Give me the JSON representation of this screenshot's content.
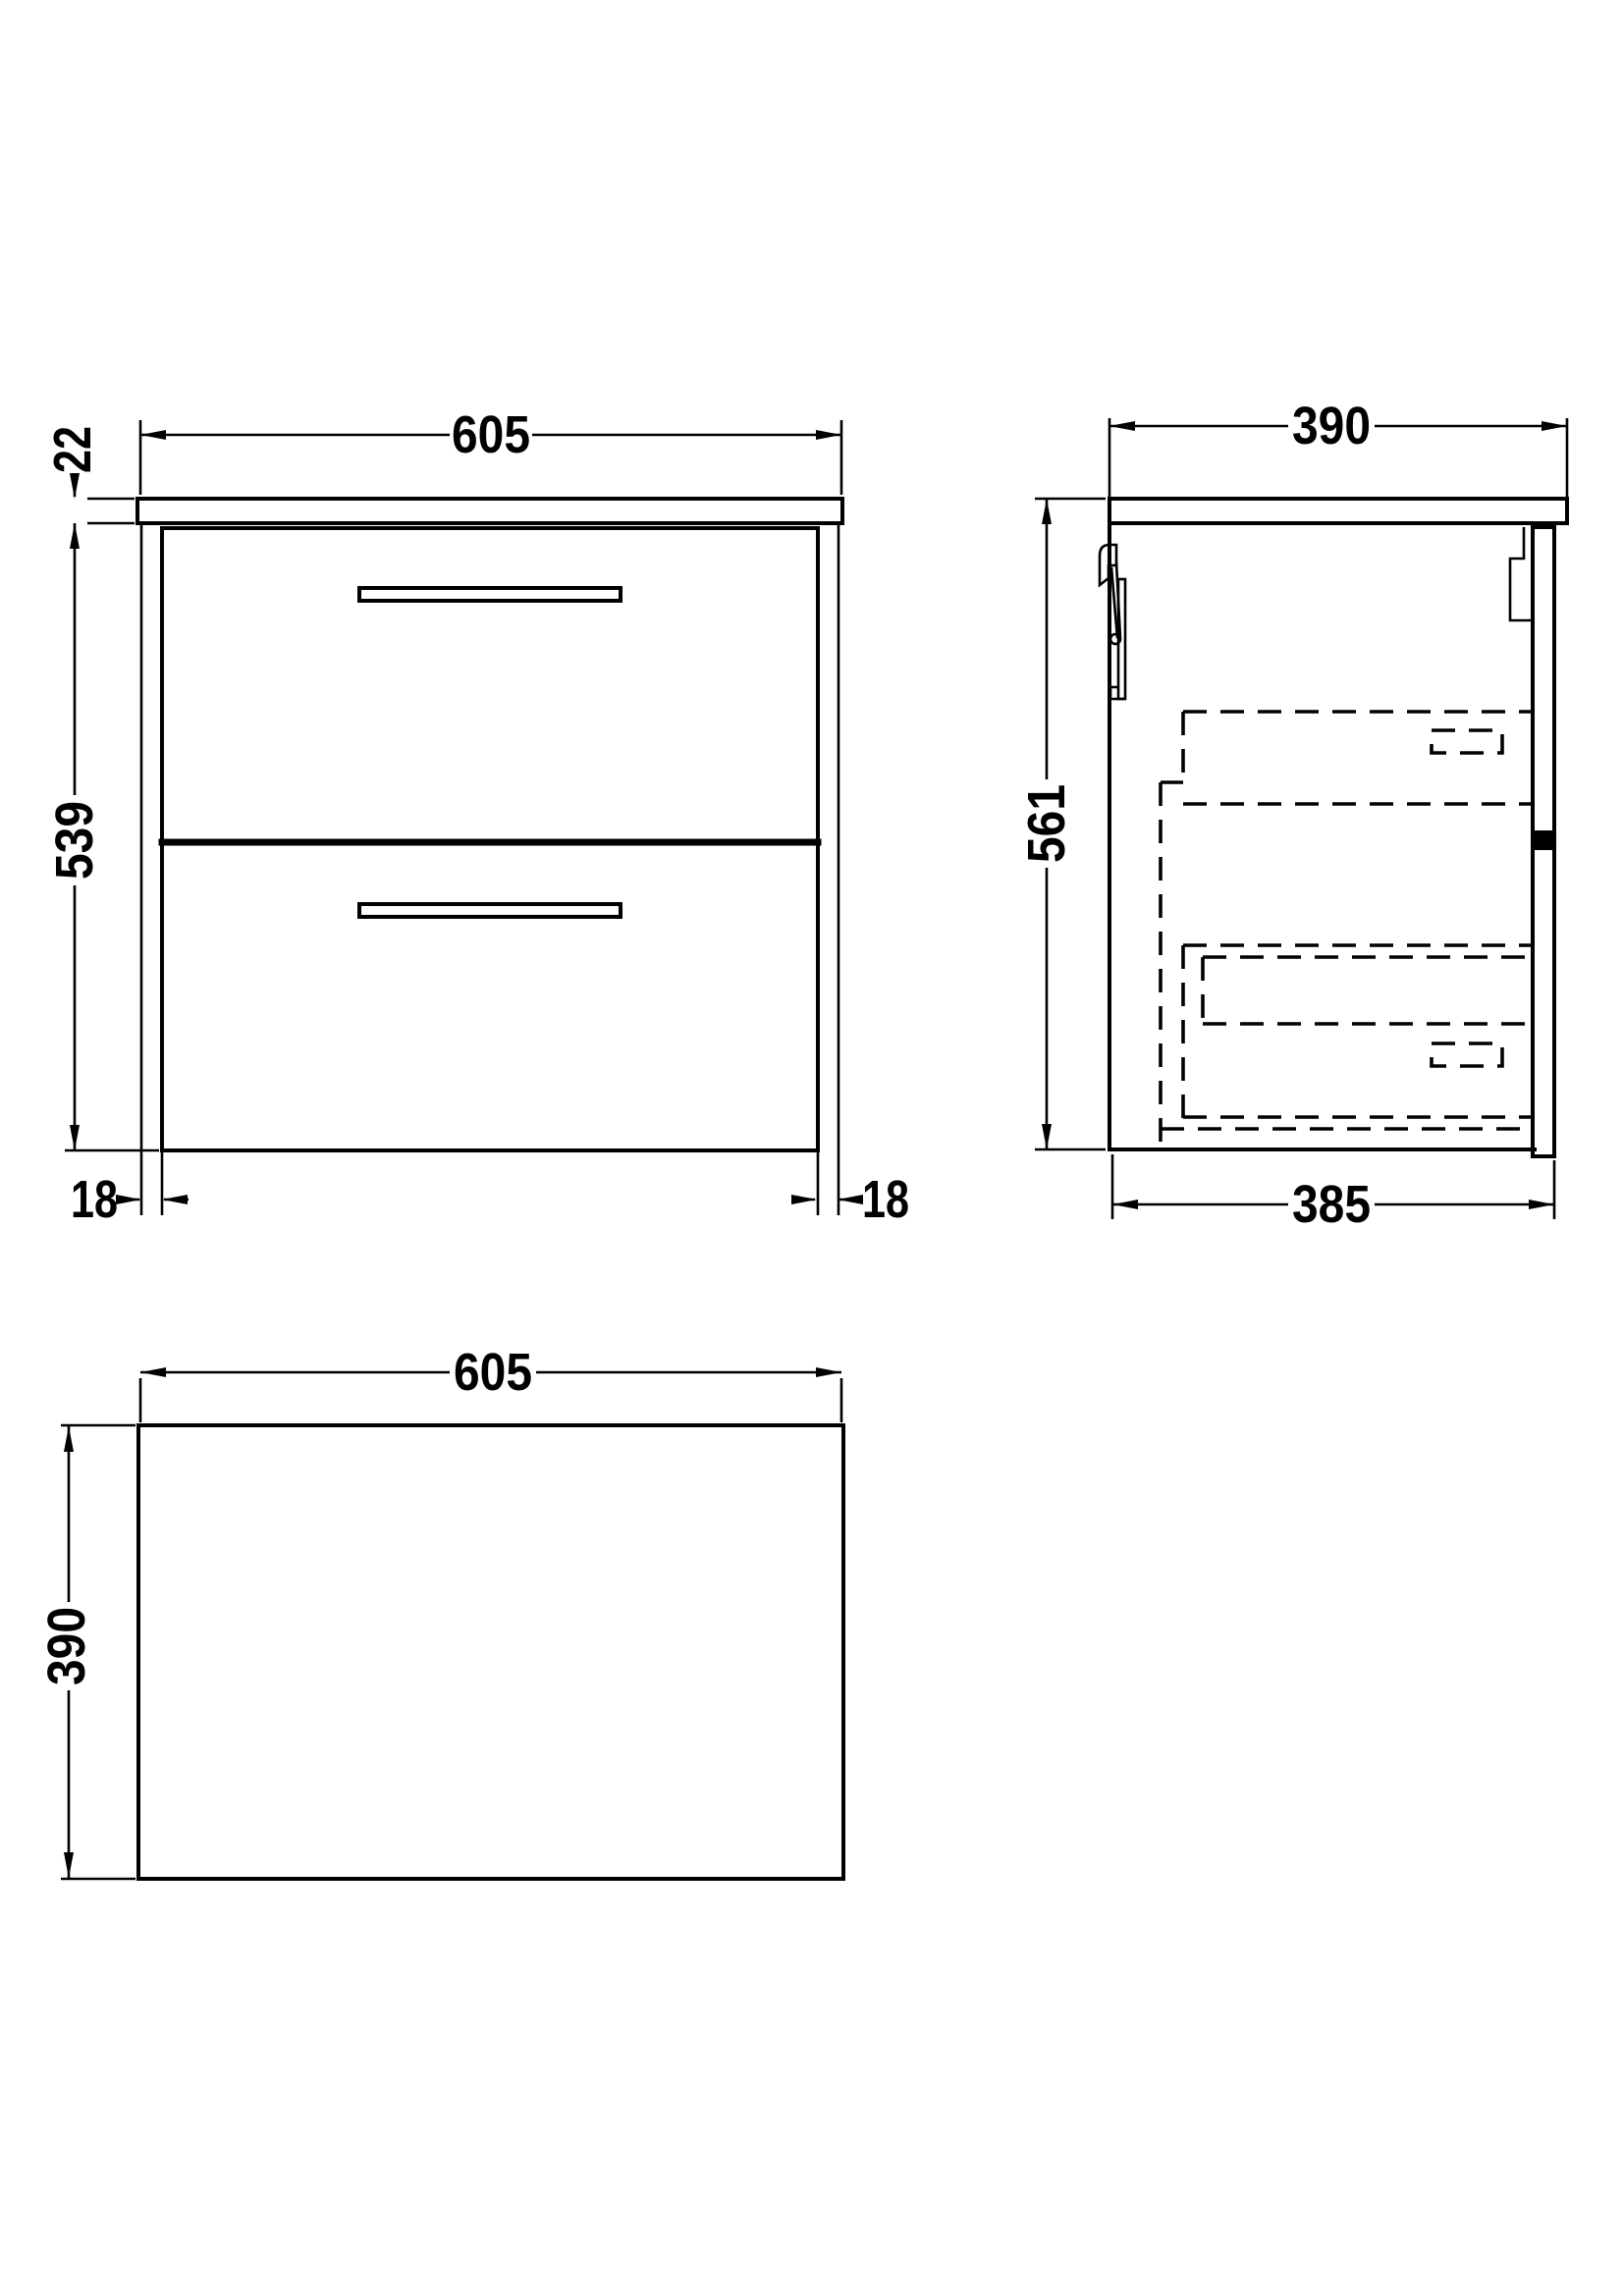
{
  "colors": {
    "background": "#ffffff",
    "line": "#000000"
  },
  "views": {
    "front": {
      "width": "605",
      "worktop_thickness": "22",
      "body_height": "539",
      "left_overhang": "18",
      "right_overhang": "18"
    },
    "side": {
      "depth": "390",
      "overall_height": "561",
      "body_depth": "385"
    },
    "plan": {
      "width": "605",
      "depth": "390"
    }
  }
}
